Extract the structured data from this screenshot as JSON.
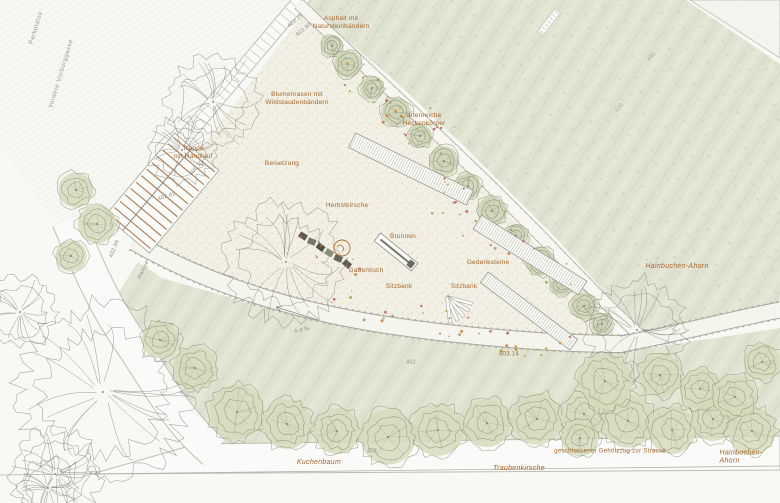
{
  "title": "Situationsplan Gedenkpark",
  "colors": {
    "paper": "#f8f8f4",
    "lawn": "#e0e2d1",
    "park_gravel": "#f2f0e5",
    "label_orange": "#a8672f",
    "label_gray": "#8f8f87",
    "step_brown": "#b5835a",
    "stone_dark": "#5a5a52"
  },
  "labels": [
    {
      "id": "parkplaetze",
      "text": "Parkplätze",
      "x": 37,
      "y": 28,
      "rot": -73,
      "style": "gray-tiny"
    },
    {
      "id": "vordere-vorburggasse",
      "text": "Vordere Vorburggasse",
      "x": 62,
      "y": 74,
      "rot": -73,
      "style": "gray-tiny"
    },
    {
      "id": "elev-403-29",
      "text": "403.29",
      "x": 296,
      "y": 21,
      "rot": -40,
      "style": "elev"
    },
    {
      "id": "elev-403-80",
      "text": "403.80",
      "x": 304,
      "y": 30,
      "rot": -40,
      "style": "elev"
    },
    {
      "id": "asphalt",
      "text": "Asphalt mit\nNatursteinbändern",
      "x": 341,
      "y": 23,
      "rot": 0,
      "style": "orange"
    },
    {
      "id": "blumenrasen",
      "text": "Blumenrasen mit\nWildstaudenbändern",
      "x": 297,
      "y": 99,
      "rot": 0,
      "style": "orange"
    },
    {
      "id": "heckenkoerper",
      "text": "artenreiche\nHeckenkörper",
      "x": 424,
      "y": 120,
      "rot": 0,
      "style": "orange"
    },
    {
      "id": "treppe",
      "text": "Treppe\nmit Handlauf",
      "x": 193,
      "y": 153,
      "rot": 0,
      "style": "orange"
    },
    {
      "id": "elev-400-29",
      "text": "400.29",
      "x": 197,
      "y": 168,
      "rot": -48,
      "style": "elev"
    },
    {
      "id": "elev-402-82",
      "text": "402.82",
      "x": 167,
      "y": 197,
      "rot": -18,
      "style": "elev"
    },
    {
      "id": "elev-402-96",
      "text": "402.96",
      "x": 115,
      "y": 249,
      "rot": -68,
      "style": "elev"
    },
    {
      "id": "rampe",
      "text": "Rampe",
      "x": 144,
      "y": 270,
      "rot": -65,
      "style": "elev"
    },
    {
      "id": "beisetzung",
      "text": "Beisetzung",
      "x": 282,
      "y": 164,
      "rot": 0,
      "style": "orange"
    },
    {
      "id": "herbstkirsche",
      "text": "Herbstkirsche",
      "x": 347,
      "y": 206,
      "rot": 0,
      "style": "orange"
    },
    {
      "id": "brunnen",
      "text": "Brunnen",
      "x": 403,
      "y": 237,
      "rot": 0,
      "style": "orange"
    },
    {
      "id": "gabentisch",
      "text": "Gabentisch",
      "x": 366,
      "y": 271,
      "rot": 0,
      "style": "orange"
    },
    {
      "id": "sitzbank-1",
      "text": "Sitzbank",
      "x": 399,
      "y": 287,
      "rot": 0,
      "style": "orange"
    },
    {
      "id": "sitzbank-2",
      "text": "Sitzbank",
      "x": 464,
      "y": 287,
      "rot": 0,
      "style": "orange"
    },
    {
      "id": "gedenksteine",
      "text": "Gedenksteine",
      "x": 488,
      "y": 263,
      "rot": 0,
      "style": "orange"
    },
    {
      "id": "hainbuchen-ahorn-1",
      "text": "Hainbuchen-Ahorn",
      "x": 677,
      "y": 267,
      "rot": 0,
      "style": "species"
    },
    {
      "id": "elev-403-14",
      "text": "403.14",
      "x": 509,
      "y": 355,
      "rot": 0,
      "style": "elev-orange"
    },
    {
      "id": "elev-402-a",
      "text": "402",
      "x": 411,
      "y": 363,
      "rot": 0,
      "style": "elev"
    },
    {
      "id": "gefaelle",
      "text": "- 4.4 %",
      "x": 300,
      "y": 331,
      "rot": -10,
      "style": "elev"
    },
    {
      "id": "gehoelzzug",
      "text": "geschlossener Gehölzzug zur Strasse",
      "x": 610,
      "y": 452,
      "rot": 0,
      "style": "elev-orange"
    },
    {
      "id": "hainbuchen-ahorn-2",
      "text": "Hainbuchen-Ahorn",
      "x": 741,
      "y": 458,
      "rot": 0,
      "style": "species"
    },
    {
      "id": "traubenkirsche",
      "text": "Traubenkirsche",
      "x": 519,
      "y": 469,
      "rot": 0,
      "style": "species"
    },
    {
      "id": "kuchenbaum",
      "text": "Kuchenbaum",
      "x": 319,
      "y": 463,
      "rot": 0,
      "style": "species"
    },
    {
      "id": "elev-402-b",
      "text": "402",
      "x": 372,
      "y": 452,
      "rot": 0,
      "style": "elev"
    },
    {
      "id": "elev-406-a",
      "text": "406",
      "x": 652,
      "y": 57,
      "rot": -48,
      "style": "elev-faint"
    },
    {
      "id": "elev-406-b",
      "text": "620",
      "x": 620,
      "y": 108,
      "rot": -48,
      "style": "elev-faint"
    }
  ],
  "plan": {
    "regions": {
      "parking": [
        [
          0,
          0
        ],
        [
          298,
          0
        ],
        [
          112,
          222
        ],
        [
          96,
          231
        ],
        [
          58,
          228
        ],
        [
          0,
          146
        ]
      ],
      "lawn_top": [
        [
          310,
          0
        ],
        [
          686,
          0
        ],
        [
          780,
          64
        ],
        [
          780,
          302
        ],
        [
          704,
          324
        ],
        [
          646,
          338
        ],
        [
          556,
          238
        ],
        [
          466,
          148
        ],
        [
          394,
          80
        ],
        [
          330,
          26
        ],
        [
          308,
          8
        ]
      ],
      "lawn_bottom": [
        [
          138,
          262
        ],
        [
          162,
          278
        ],
        [
          232,
          298
        ],
        [
          332,
          324
        ],
        [
          462,
          342
        ],
        [
          622,
          352
        ],
        [
          702,
          340
        ],
        [
          780,
          328
        ],
        [
          780,
          440
        ],
        [
          618,
          444
        ],
        [
          198,
          450
        ],
        [
          148,
          378
        ],
        [
          114,
          300
        ]
      ],
      "wedge": [
        [
          690,
          0
        ],
        [
          780,
          0
        ],
        [
          780,
          58
        ]
      ],
      "park": [
        [
          303,
          14
        ],
        [
          132,
          238
        ],
        [
          152,
          252
        ],
        [
          212,
          284
        ],
        [
          302,
          314
        ],
        [
          422,
          332
        ],
        [
          532,
          340
        ],
        [
          612,
          342
        ],
        [
          614,
          330
        ],
        [
          540,
          248
        ],
        [
          468,
          168
        ],
        [
          398,
          94
        ],
        [
          330,
          28
        ]
      ]
    },
    "roads": {
      "walkway_nw": "M306,-6 L110,226",
      "street_left": "M68,220 C86,262 102,302 130,342 C156,380 176,420 214,452",
      "path_lower": "M134,242 C200,280 280,308 380,324 C470,338 562,344 626,344",
      "path_upper": "M299,4 C356,60 468,160 558,254 C600,298 630,328 650,344",
      "path_right": "M622,344 C676,334 728,320 780,310",
      "street_bottom": [
        [
          196,
          444
        ],
        [
          780,
          436
        ],
        [
          780,
          470
        ],
        [
          92,
          474
        ]
      ],
      "street_bottom_line": [
        [
          0,
          475
        ],
        [
          780,
          466
        ]
      ]
    },
    "stairs": {
      "cx": 162,
      "cy": 193,
      "w": 58,
      "len": 108,
      "rot": 40,
      "steps": 13
    },
    "pergolas": [
      {
        "cx": 411,
        "cy": 169,
        "len": 131,
        "w": 16,
        "rot": 26
      },
      {
        "cx": 530,
        "cy": 255,
        "len": 124,
        "w": 16,
        "rot": 32
      },
      {
        "cx": 529,
        "cy": 311,
        "len": 112,
        "w": 13,
        "rot": 37
      }
    ],
    "fountain": {
      "cx": 396,
      "cy": 252,
      "len": 48,
      "w": 10,
      "rot": 39
    },
    "stones": {
      "x1": 303,
      "y1": 236,
      "x2": 347,
      "y2": 264,
      "n": 6
    },
    "fan_bench": {
      "px": 447,
      "py": 297,
      "slat_len": 26,
      "slat_w": 3.2,
      "angles": [
        15,
        32,
        49,
        66,
        83
      ]
    },
    "marker": {
      "cx": 342,
      "cy": 248,
      "r": 8
    },
    "hedge": [
      [
        332,
        46,
        12
      ],
      [
        348,
        64,
        15
      ],
      [
        372,
        88,
        13
      ],
      [
        396,
        112,
        16
      ],
      [
        420,
        136,
        13
      ],
      [
        444,
        161,
        16
      ],
      [
        468,
        186,
        14
      ],
      [
        492,
        211,
        16
      ],
      [
        516,
        236,
        13
      ],
      [
        540,
        261,
        16
      ],
      [
        562,
        284,
        13
      ],
      [
        584,
        306,
        15
      ],
      [
        602,
        324,
        12
      ]
    ],
    "trees": [
      [
        103,
        392,
        88,
        "branchy",
        1
      ],
      [
        55,
        474,
        46,
        "branchy",
        2
      ],
      [
        213,
        102,
        46,
        "branchy",
        3
      ],
      [
        182,
        150,
        34,
        "branchy",
        4
      ],
      [
        286,
        262,
        60,
        "branchy",
        5
      ],
      [
        637,
        330,
        52,
        "branchy",
        6
      ],
      [
        20,
        312,
        36,
        "branchy",
        7
      ],
      [
        48,
        488,
        30,
        "branchy",
        8
      ],
      [
        76,
        190,
        19,
        "green",
        9
      ],
      [
        97,
        224,
        21,
        "green",
        10
      ],
      [
        71,
        256,
        17,
        "green",
        11
      ],
      [
        237,
        412,
        30,
        "green",
        12
      ],
      [
        287,
        424,
        27,
        "green",
        13
      ],
      [
        337,
        431,
        25,
        "green",
        14
      ],
      [
        388,
        437,
        30,
        "green",
        15
      ],
      [
        438,
        430,
        28,
        "green",
        16
      ],
      [
        487,
        423,
        26,
        "green",
        17
      ],
      [
        537,
        419,
        28,
        "green",
        18
      ],
      [
        584,
        414,
        24,
        "green",
        19
      ],
      [
        628,
        421,
        29,
        "green",
        20
      ],
      [
        672,
        430,
        26,
        "green",
        21
      ],
      [
        713,
        419,
        24,
        "green",
        22
      ],
      [
        752,
        431,
        26,
        "green",
        23
      ],
      [
        700,
        389,
        22,
        "green",
        24
      ],
      [
        605,
        381,
        30,
        "green",
        25
      ],
      [
        660,
        375,
        24,
        "green",
        26
      ],
      [
        580,
        438,
        20,
        "green",
        27
      ],
      [
        762,
        362,
        20,
        "green",
        28
      ],
      [
        735,
        397,
        24,
        "green",
        29
      ],
      [
        195,
        368,
        24,
        "green",
        30
      ],
      [
        160,
        340,
        20,
        "green",
        31
      ]
    ],
    "flower_zones": [
      {
        "x1": 335,
        "y1": 78,
        "x2": 468,
        "y2": 152,
        "jitter": 22,
        "n": 26,
        "seed": 11
      },
      {
        "x1": 432,
        "y1": 196,
        "x2": 584,
        "y2": 298,
        "jitter": 24,
        "n": 22,
        "seed": 22
      },
      {
        "x1": 330,
        "y1": 300,
        "x2": 568,
        "y2": 350,
        "jitter": 15,
        "n": 30,
        "seed": 33
      },
      {
        "x1": 300,
        "y1": 238,
        "x2": 360,
        "y2": 270,
        "jitter": 9,
        "n": 12,
        "seed": 44
      }
    ],
    "flower_colors": [
      "#c2793f",
      "#ba6371",
      "#96a04f",
      "#c9a24e"
    ],
    "arrows": [
      {
        "x1": 318,
        "y1": 320,
        "x2": 276,
        "y2": 307
      }
    ],
    "survey_marks": [
      {
        "x": 549,
        "y": 22,
        "rot": -52
      }
    ]
  }
}
